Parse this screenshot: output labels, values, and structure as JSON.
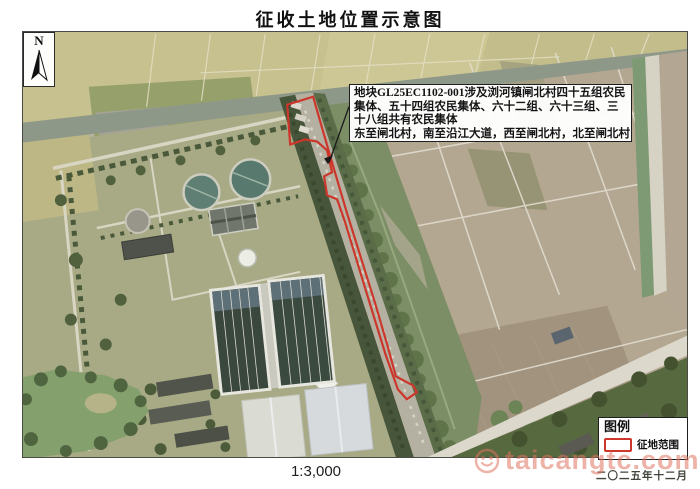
{
  "title": "征收土地位置示意图",
  "map": {
    "north_label": "N",
    "annotation": {
      "lines": [
        "地块GL25EC1102-001涉及浏河镇闸北村四十五组农民",
        "集体、五十四组农民集体、六十二组、六十三组、三",
        "十八组共有农民集体",
        "东至闸北村，南至沿江大道，西至闸北村，北至闸北村"
      ]
    }
  },
  "legend": {
    "title": "图例",
    "items": [
      {
        "label": "征地范围",
        "symbol": "red-dashed-rectangle",
        "color": "#cd362b"
      }
    ]
  },
  "footer": {
    "scale": "1:3,000",
    "date": "二〇二五年十二月"
  },
  "watermark": {
    "icon": "smiley-circle-icon",
    "text": "taicangtc.com"
  },
  "colors": {
    "acquisition_outline": "#cd362b",
    "farmland": "#b4a792",
    "cropland_top": "#c6c18e",
    "canal": "#8e9889",
    "campus_lawn": "#a7aa85"
  }
}
